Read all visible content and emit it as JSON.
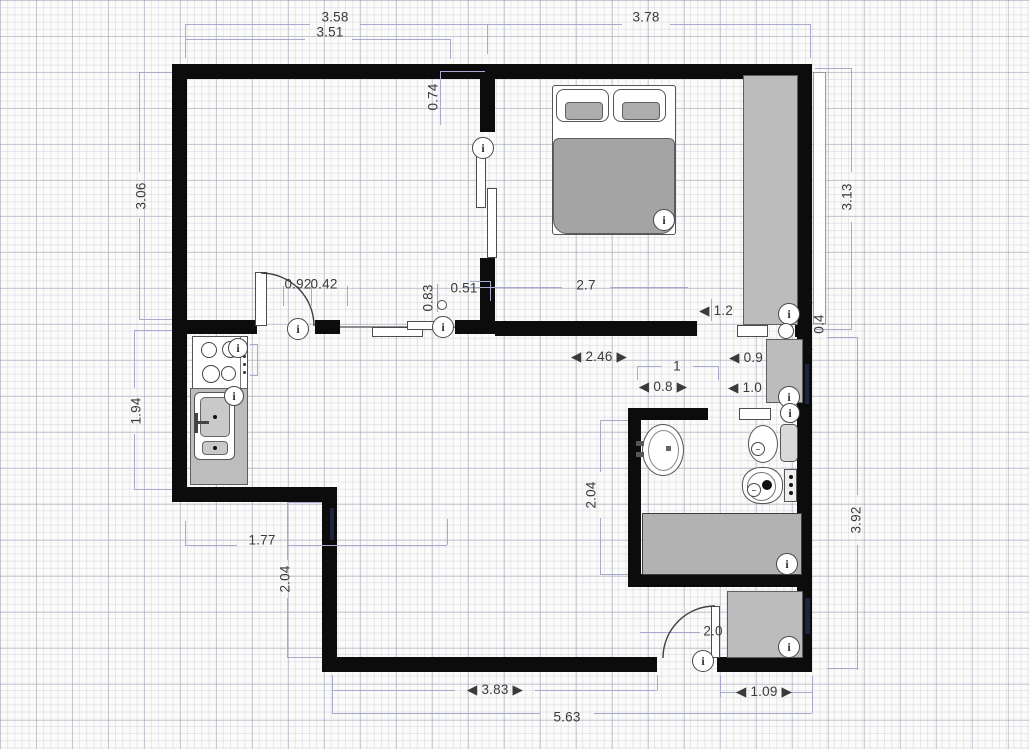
{
  "canvas": {
    "width": 1029,
    "height": 749,
    "background": "#fbfbf9"
  },
  "colors": {
    "wall": "#0c0c0c",
    "furniture_fill": "#bcbcbc",
    "furniture_border": "#5f5f5f",
    "dimension_line": "#a9a9d0",
    "dimension_text": "#3a3a3a",
    "window_mark": "#1d2440"
  },
  "icons_legend": {
    "info_icon_glyph": "i",
    "door_pivot_glyph": "",
    "fixture_mini_glyph": "–"
  },
  "dimensions": {
    "labels": [
      {
        "text": "3.58",
        "x": 335,
        "y": 17,
        "rot": false
      },
      {
        "text": "3.51",
        "x": 330,
        "y": 32,
        "rot": false
      },
      {
        "text": "3.78",
        "x": 646,
        "y": 17,
        "rot": false
      },
      {
        "text": "0.74",
        "x": 433,
        "y": 97,
        "rot": true
      },
      {
        "text": "3.06",
        "x": 141,
        "y": 196,
        "rot": true
      },
      {
        "text": "3.13",
        "x": 847,
        "y": 197,
        "rot": true
      },
      {
        "text": "1.94",
        "x": 136,
        "y": 411,
        "rot": true
      },
      {
        "text": "0.92",
        "x": 298,
        "y": 284,
        "rot": false
      },
      {
        "text": "0.42",
        "x": 324,
        "y": 284,
        "rot": false
      },
      {
        "text": "0.83",
        "x": 428,
        "y": 298,
        "rot": true
      },
      {
        "text": "0.51",
        "x": 464,
        "y": 288,
        "rot": false
      },
      {
        "text": "2.7",
        "x": 586,
        "y": 285,
        "rot": false
      },
      {
        "text": "◀ 1.2",
        "x": 716,
        "y": 311,
        "rot": false
      },
      {
        "text": "◀ 2.46 ▶",
        "x": 599,
        "y": 357,
        "rot": false
      },
      {
        "text": "◀ 0.9",
        "x": 746,
        "y": 358,
        "rot": false
      },
      {
        "text": "1",
        "x": 677,
        "y": 366,
        "rot": false
      },
      {
        "text": "◀ 0.8 ▶",
        "x": 663,
        "y": 387,
        "rot": false
      },
      {
        "text": "◀ 1.0",
        "x": 745,
        "y": 388,
        "rot": false
      },
      {
        "text": "2.04",
        "x": 591,
        "y": 495,
        "rot": true
      },
      {
        "text": "3.92",
        "x": 856,
        "y": 520,
        "rot": true
      },
      {
        "text": "1.77",
        "x": 262,
        "y": 540,
        "rot": false
      },
      {
        "text": "2.04",
        "x": 285,
        "y": 579,
        "rot": true
      },
      {
        "text": "0.4",
        "x": 819,
        "y": 324,
        "rot": true
      },
      {
        "text": "▲",
        "x": 810,
        "y": 300,
        "rot": false,
        "arrow": true
      },
      {
        "text": "▼",
        "x": 810,
        "y": 351,
        "rot": false,
        "arrow": true
      },
      {
        "text": "2.0",
        "x": 713,
        "y": 631,
        "rot": false
      },
      {
        "text": "◀ 3.83 ▶",
        "x": 495,
        "y": 690,
        "rot": false
      },
      {
        "text": "◀ 1.09 ▶",
        "x": 764,
        "y": 692,
        "rot": false
      },
      {
        "text": "5.63",
        "x": 567,
        "y": 717,
        "rot": false
      }
    ],
    "lines": [
      [
        185,
        24,
        125,
        1
      ],
      [
        360,
        24,
        127,
        1
      ],
      [
        185,
        24,
        1,
        34
      ],
      [
        487,
        24,
        1,
        30
      ],
      [
        185,
        39,
        120,
        1
      ],
      [
        352,
        39,
        98,
        1
      ],
      [
        450,
        39,
        1,
        20
      ],
      [
        487,
        24,
        135,
        1
      ],
      [
        670,
        24,
        140,
        1
      ],
      [
        810,
        24,
        1,
        34
      ],
      [
        139,
        72,
        1,
        100
      ],
      [
        139,
        218,
        1,
        102
      ],
      [
        139,
        72,
        33,
        1
      ],
      [
        139,
        319,
        33,
        1
      ],
      [
        134,
        330,
        1,
        58
      ],
      [
        134,
        434,
        1,
        56
      ],
      [
        134,
        330,
        38,
        1
      ],
      [
        134,
        489,
        38,
        1
      ],
      [
        440,
        71,
        45,
        1
      ],
      [
        440,
        71,
        1,
        54
      ],
      [
        851,
        68,
        1,
        104
      ],
      [
        851,
        222,
        1,
        108
      ],
      [
        815,
        68,
        36,
        1
      ],
      [
        815,
        329,
        36,
        1
      ],
      [
        857,
        337,
        1,
        158
      ],
      [
        857,
        545,
        1,
        125
      ],
      [
        827,
        337,
        30,
        1
      ],
      [
        827,
        668,
        30,
        1
      ],
      [
        462,
        287,
        100,
        1
      ],
      [
        610,
        287,
        78,
        1
      ],
      [
        711,
        299,
        1,
        22
      ],
      [
        637,
        366,
        1,
        14
      ],
      [
        637,
        366,
        25,
        1
      ],
      [
        693,
        366,
        25,
        1
      ],
      [
        718,
        366,
        1,
        14
      ],
      [
        600,
        420,
        1,
        52
      ],
      [
        600,
        518,
        1,
        57
      ],
      [
        600,
        420,
        28,
        1
      ],
      [
        600,
        574,
        28,
        1
      ],
      [
        185,
        545,
        52,
        1
      ],
      [
        287,
        545,
        160,
        1
      ],
      [
        185,
        521,
        1,
        24
      ],
      [
        447,
        519,
        1,
        26
      ],
      [
        287,
        502,
        1,
        58
      ],
      [
        287,
        598,
        1,
        60
      ],
      [
        287,
        502,
        35,
        1
      ],
      [
        287,
        657,
        35,
        1
      ],
      [
        640,
        632,
        60,
        1
      ],
      [
        332,
        690,
        123,
        1
      ],
      [
        535,
        690,
        122,
        1
      ],
      [
        332,
        675,
        1,
        15
      ],
      [
        657,
        675,
        1,
        15
      ],
      [
        332,
        713,
        208,
        1
      ],
      [
        594,
        713,
        218,
        1
      ],
      [
        332,
        683,
        1,
        30
      ],
      [
        812,
        690,
        1,
        23
      ],
      [
        720,
        676,
        1,
        21
      ],
      [
        812,
        676,
        1,
        21
      ],
      [
        720,
        692,
        22,
        1
      ],
      [
        788,
        692,
        24,
        1
      ],
      [
        283,
        286,
        1,
        20
      ],
      [
        311,
        286,
        1,
        20
      ],
      [
        347,
        286,
        1,
        20
      ],
      [
        437,
        284,
        1,
        28
      ],
      [
        470,
        281,
        20,
        1
      ],
      [
        490,
        281,
        1,
        20
      ],
      [
        257,
        344,
        1,
        32
      ],
      [
        250,
        344,
        8,
        1
      ],
      [
        250,
        375,
        8,
        1
      ]
    ]
  },
  "icons": [
    {
      "name": "info-icon-interior-door",
      "glyph": "i",
      "x": 298,
      "y": 329,
      "r": 11
    },
    {
      "name": "info-icon-sliding-door-hall",
      "glyph": "i",
      "x": 443,
      "y": 327,
      "r": 11
    },
    {
      "name": "info-icon-sliding-door-bedroom",
      "glyph": "i",
      "x": 483,
      "y": 148,
      "r": 11
    },
    {
      "name": "info-icon-stove",
      "glyph": "i",
      "x": 238,
      "y": 348,
      "r": 10
    },
    {
      "name": "info-icon-kitchen-sink",
      "glyph": "i",
      "x": 234,
      "y": 396,
      "r": 10
    },
    {
      "name": "info-icon-bed",
      "glyph": "i",
      "x": 664,
      "y": 220,
      "r": 11
    },
    {
      "name": "info-icon-wardrobe",
      "glyph": "i",
      "x": 789,
      "y": 314,
      "r": 11
    },
    {
      "name": "info-icon-hall-cabinet",
      "glyph": "i",
      "x": 789,
      "y": 397,
      "r": 11
    },
    {
      "name": "info-icon-bathroom-door",
      "glyph": "i",
      "x": 790,
      "y": 413,
      "r": 10
    },
    {
      "name": "info-icon-bathtub",
      "glyph": "i",
      "x": 787,
      "y": 564,
      "r": 11
    },
    {
      "name": "info-icon-entry-cabinet",
      "glyph": "i",
      "x": 789,
      "y": 647,
      "r": 11
    },
    {
      "name": "info-icon-entry-door",
      "glyph": "i",
      "x": 703,
      "y": 661,
      "r": 11
    },
    {
      "name": "door-pivot",
      "glyph": "",
      "x": 786,
      "y": 331,
      "r": 8,
      "plain": true
    },
    {
      "name": "door-handle-oval",
      "glyph": "",
      "x": 442,
      "y": 305,
      "r": 5,
      "plain": true
    },
    {
      "name": "toilet-mini-icon",
      "glyph": "–",
      "x": 758,
      "y": 449,
      "r": 7,
      "mini": true
    },
    {
      "name": "bidet-mini-icon",
      "glyph": "–",
      "x": 754,
      "y": 490,
      "r": 7,
      "mini": true
    }
  ],
  "windows": [
    {
      "name": "window-strip-bedroom-right",
      "x": 813,
      "y": 72,
      "w": 13,
      "h": 252,
      "style": "strip"
    },
    {
      "name": "window-mark-lower-left-wall",
      "x": 330,
      "y": 508,
      "w": 4,
      "h": 32,
      "style": "mark"
    },
    {
      "name": "window-mark-hall-right-wall",
      "x": 805,
      "y": 364,
      "w": 4,
      "h": 40,
      "style": "mark"
    },
    {
      "name": "window-mark-entry-right-wall",
      "x": 805,
      "y": 598,
      "w": 5,
      "h": 36,
      "style": "mark"
    }
  ]
}
